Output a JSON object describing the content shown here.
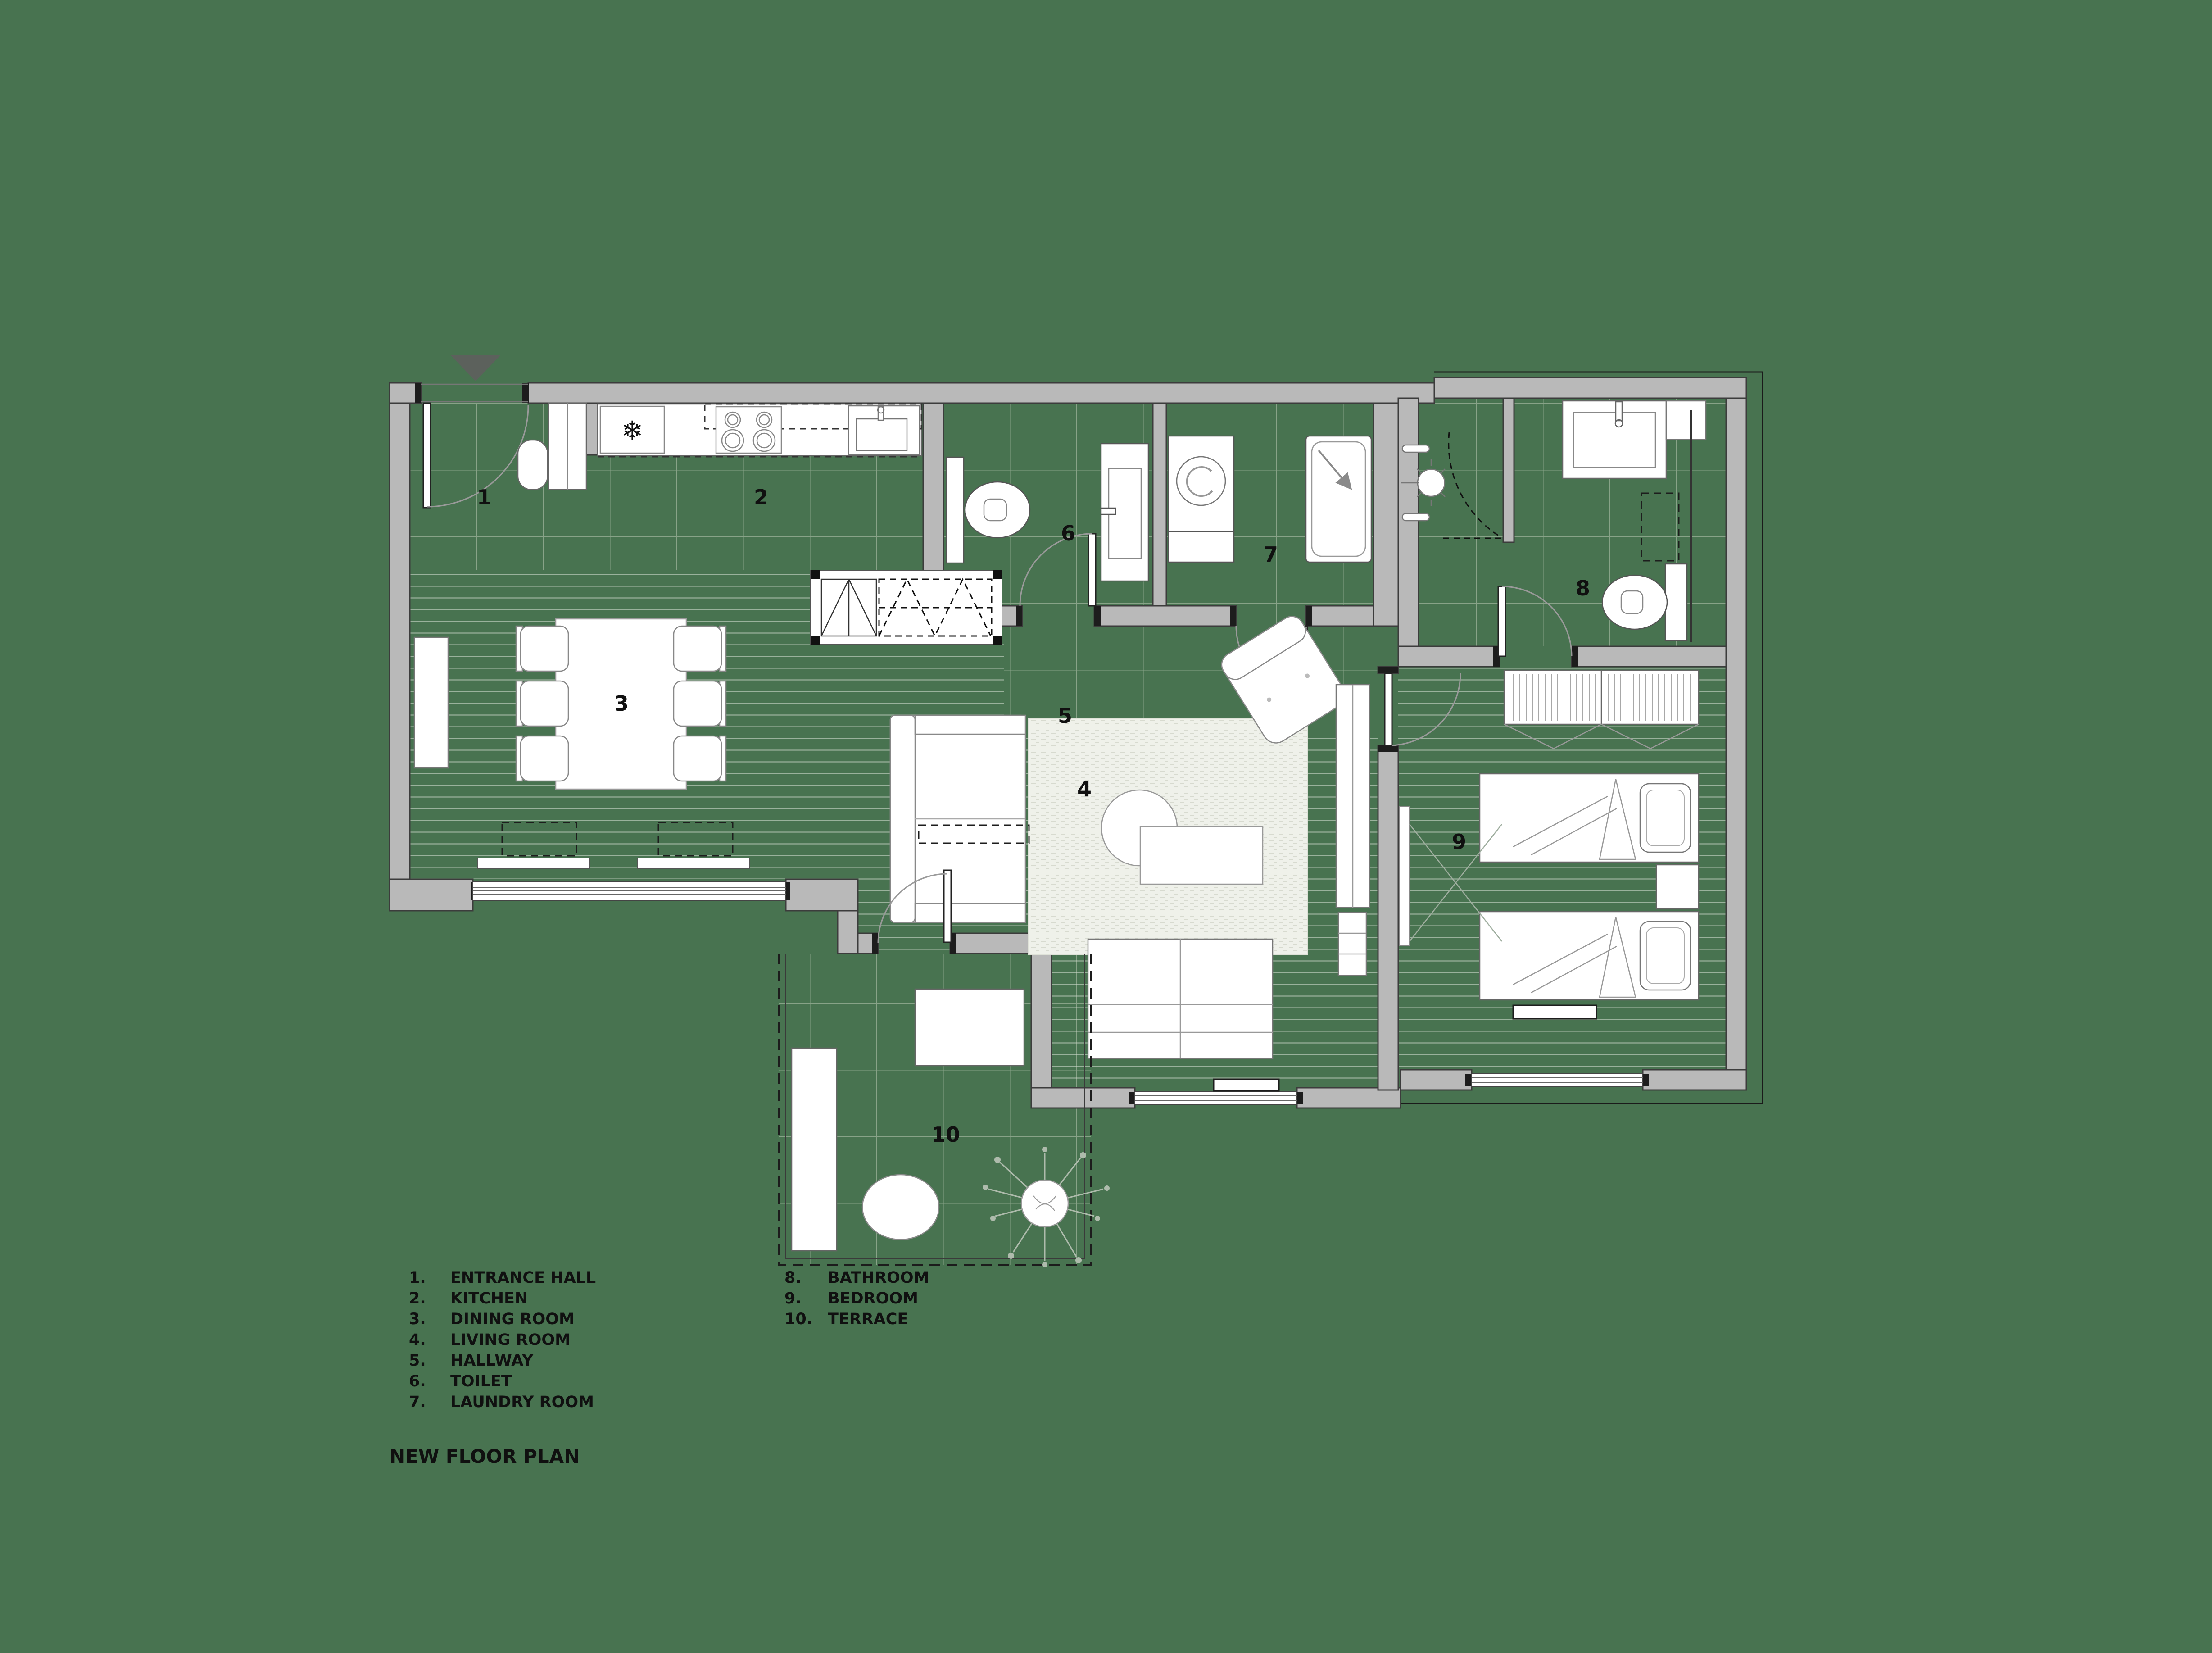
{
  "title": "NEW FLOOR PLAN",
  "colors": {
    "background": "#487350",
    "wall_fill": "#b9b9b9",
    "wall_outline": "#3c3c3c",
    "furniture_fill": "#ffffff",
    "furniture_line": "#7a7a7a",
    "tile_line": "#9db29b",
    "wood_line": "#cdd8cb",
    "text": "#101010",
    "north_marker": "#5c615c"
  },
  "icons": {
    "snowflake": "❄"
  },
  "rooms": [
    {
      "number": "1",
      "number_label": "1.",
      "name": "ENTRANCE HALL"
    },
    {
      "number": "2",
      "number_label": "2.",
      "name": "KITCHEN"
    },
    {
      "number": "3",
      "number_label": "3.",
      "name": "DINING ROOM"
    },
    {
      "number": "4",
      "number_label": "4.",
      "name": "LIVING ROOM"
    },
    {
      "number": "5",
      "number_label": "5.",
      "name": "HALLWAY"
    },
    {
      "number": "6",
      "number_label": "6.",
      "name": "TOILET"
    },
    {
      "number": "7",
      "number_label": "7.",
      "name": "LAUNDRY ROOM"
    },
    {
      "number": "8",
      "number_label": "8.",
      "name": "BATHROOM"
    },
    {
      "number": "9",
      "number_label": "9.",
      "name": "BEDROOM"
    },
    {
      "number": "10",
      "number_label": "10.",
      "name": "TERRACE"
    }
  ]
}
